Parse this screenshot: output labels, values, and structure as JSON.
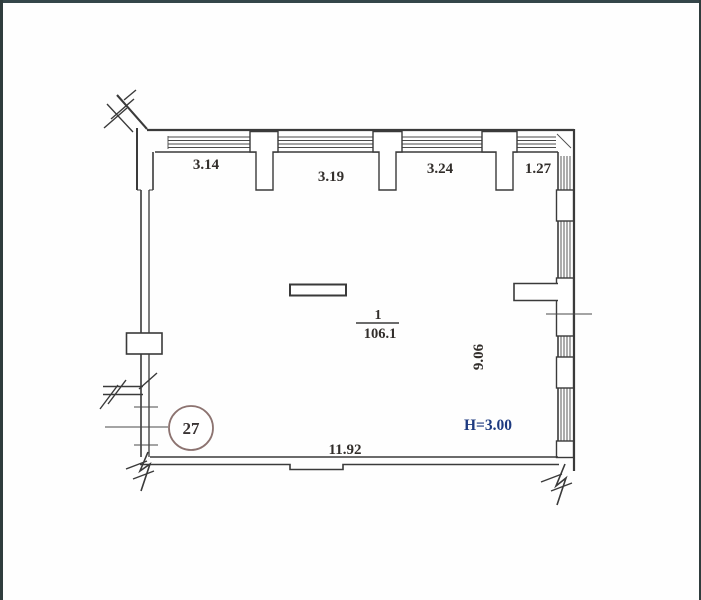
{
  "plan": {
    "top_dimensions": [
      "3.14",
      "3.19",
      "3.24",
      "1.27"
    ],
    "bottom_dimension": "11.92",
    "side_dimension": "9.06",
    "ceiling_height": "H=3.00",
    "room_number": "1",
    "room_area": "106.1",
    "unit_number": "27"
  },
  "colors": {
    "line": "#3a3a3a",
    "dimension_text": "#322e2b",
    "height_text": "#1d3a80",
    "unit_circle_stroke": "#8c7370",
    "frame_edge": "#35464a",
    "background": "#fefefe"
  }
}
